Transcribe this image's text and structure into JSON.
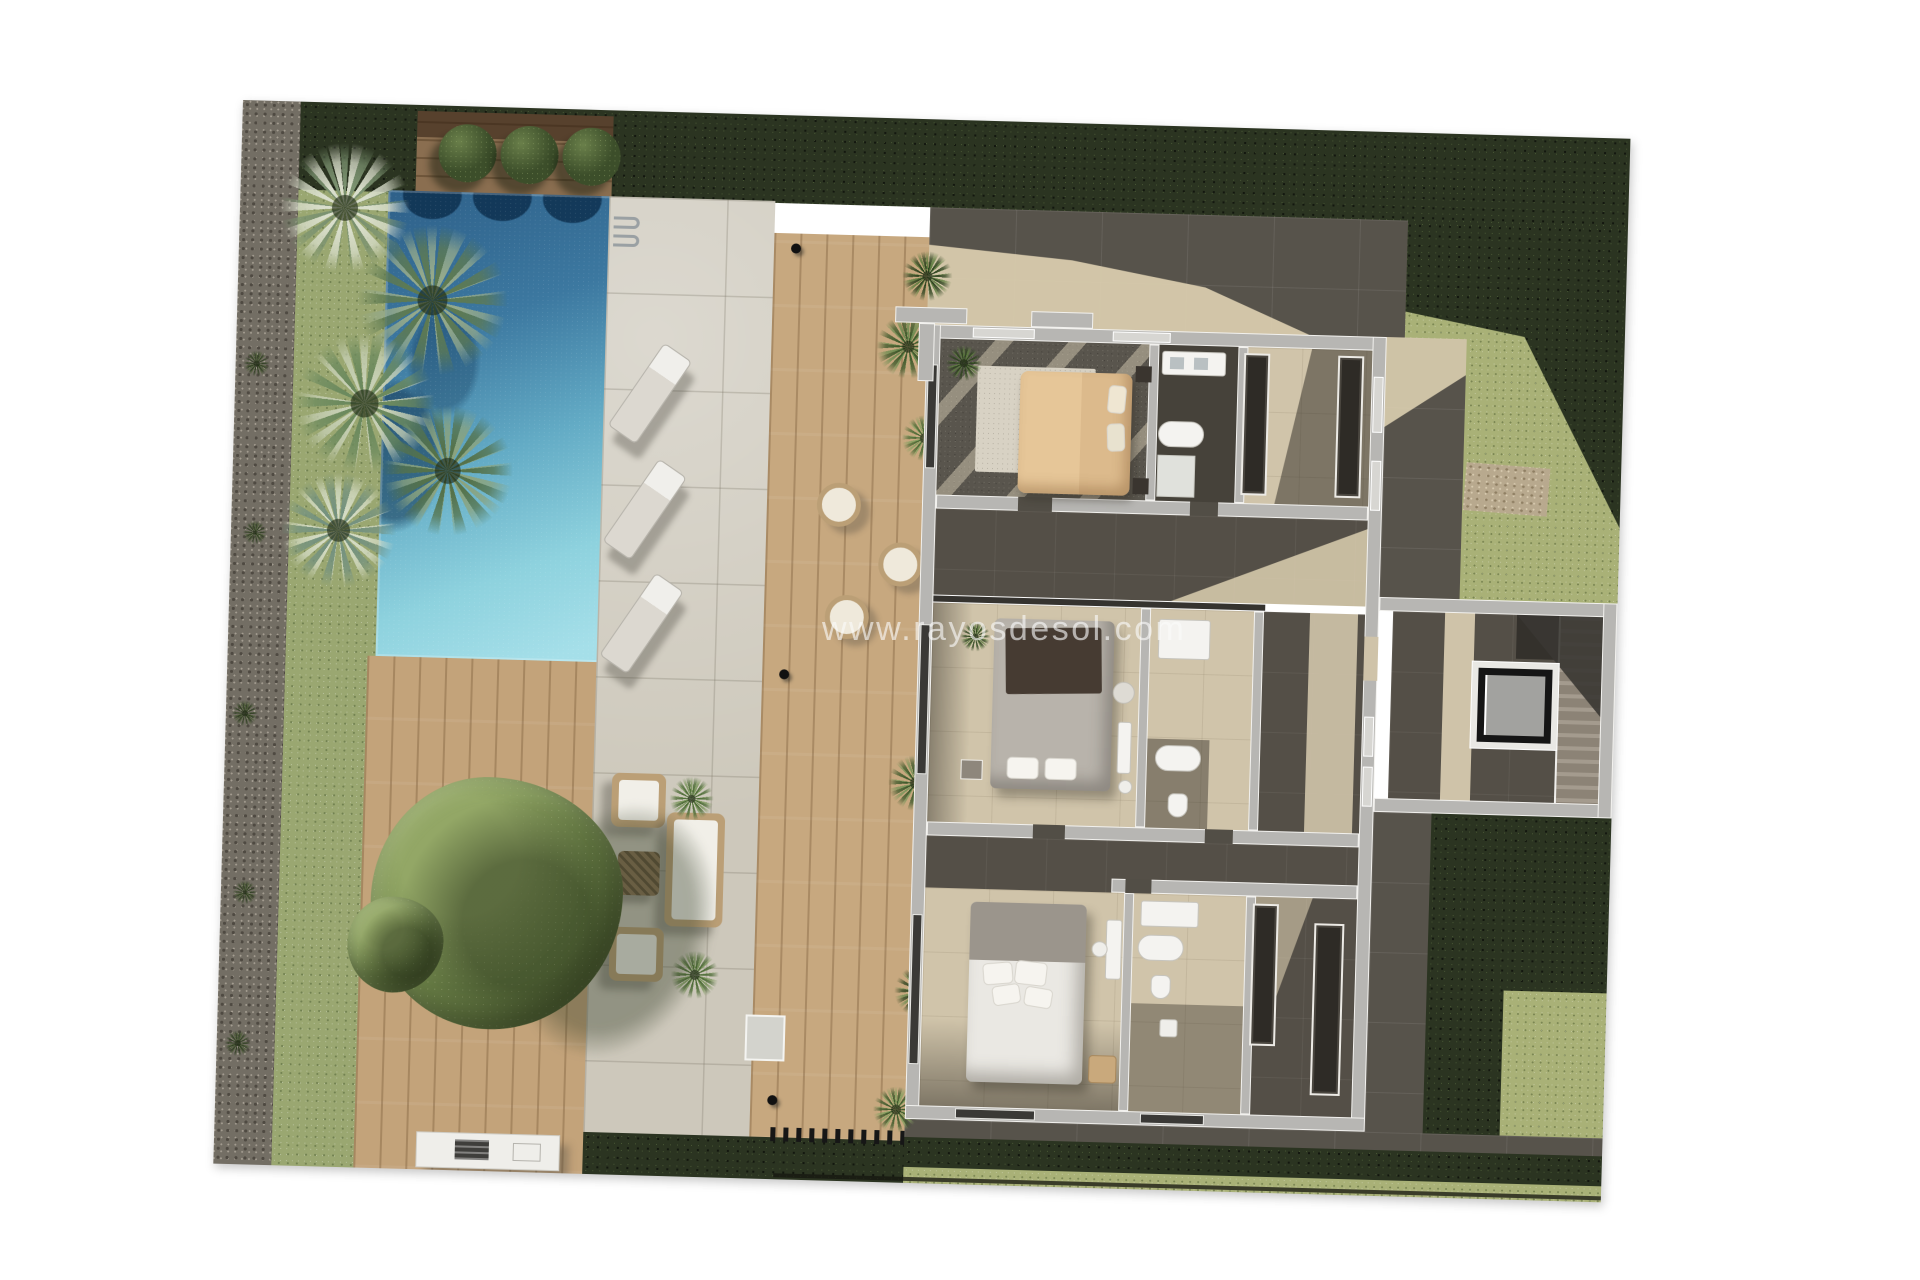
{
  "watermark": {
    "text": "www.rayosdesol.com"
  },
  "plan": {
    "type": "architectural floor plan",
    "view": "top-down 3D render of a villa upper floor with garden and pool",
    "rotation_deg": 1.6,
    "features": {
      "outdoor": [
        "swimming pool",
        "wood sun deck",
        "planter with round bushes",
        "palm trees",
        "garden tree",
        "sun loungers",
        "round lounge chairs",
        "outdoor sofa set",
        "barbecue counter",
        "pergola walkway",
        "gravel border",
        "hedges",
        "lawn",
        "pebble path",
        "pool ladder",
        "outdoor shower"
      ],
      "indoor": [
        "bedroom with tan bed",
        "bedroom with gray bed",
        "bedroom with white bed",
        "bathroom",
        "bathroom",
        "bathroom",
        "walk-in closet",
        "walk-in closet",
        "gallery hallway",
        "corridor",
        "stairwell",
        "elevator"
      ]
    },
    "colors": {
      "page_bg": "#ffffff",
      "gravel": "#736e64",
      "grass_light": "#9aa771",
      "grass_right": "#a9b177",
      "hedge_dark": "#2b3421",
      "wood_planter": "#8a6e50",
      "wood_deck": "#c3a37a",
      "pool_deep": "#2e6089",
      "pool_light": "#a5dfe9",
      "stone_patio": "#cdc8bb",
      "paving_dark": "#57534b",
      "sun_beige": "#dccfb0",
      "wall_gray": "#b7b6b3",
      "wall_trim": "#f2f1ee",
      "floor_dark": "#544f47",
      "floor_beige": "#d0c4aa",
      "bed_tan": "#dcba8c",
      "bed_gray": "#b8b3ab",
      "throw_dark": "#463b32",
      "bed_white": "#eae8e3",
      "fixture_white": "#f4f3f0",
      "wardrobe_dark": "#2e2b26",
      "elevator_cab": "#a2a29f",
      "tree_green": "#71874c",
      "bush_green": "#3c4e2a",
      "plant_green": "#5d7c3f",
      "rattan": "#bb9f76",
      "watermark": "rgba(250,250,250,0.62)"
    }
  }
}
